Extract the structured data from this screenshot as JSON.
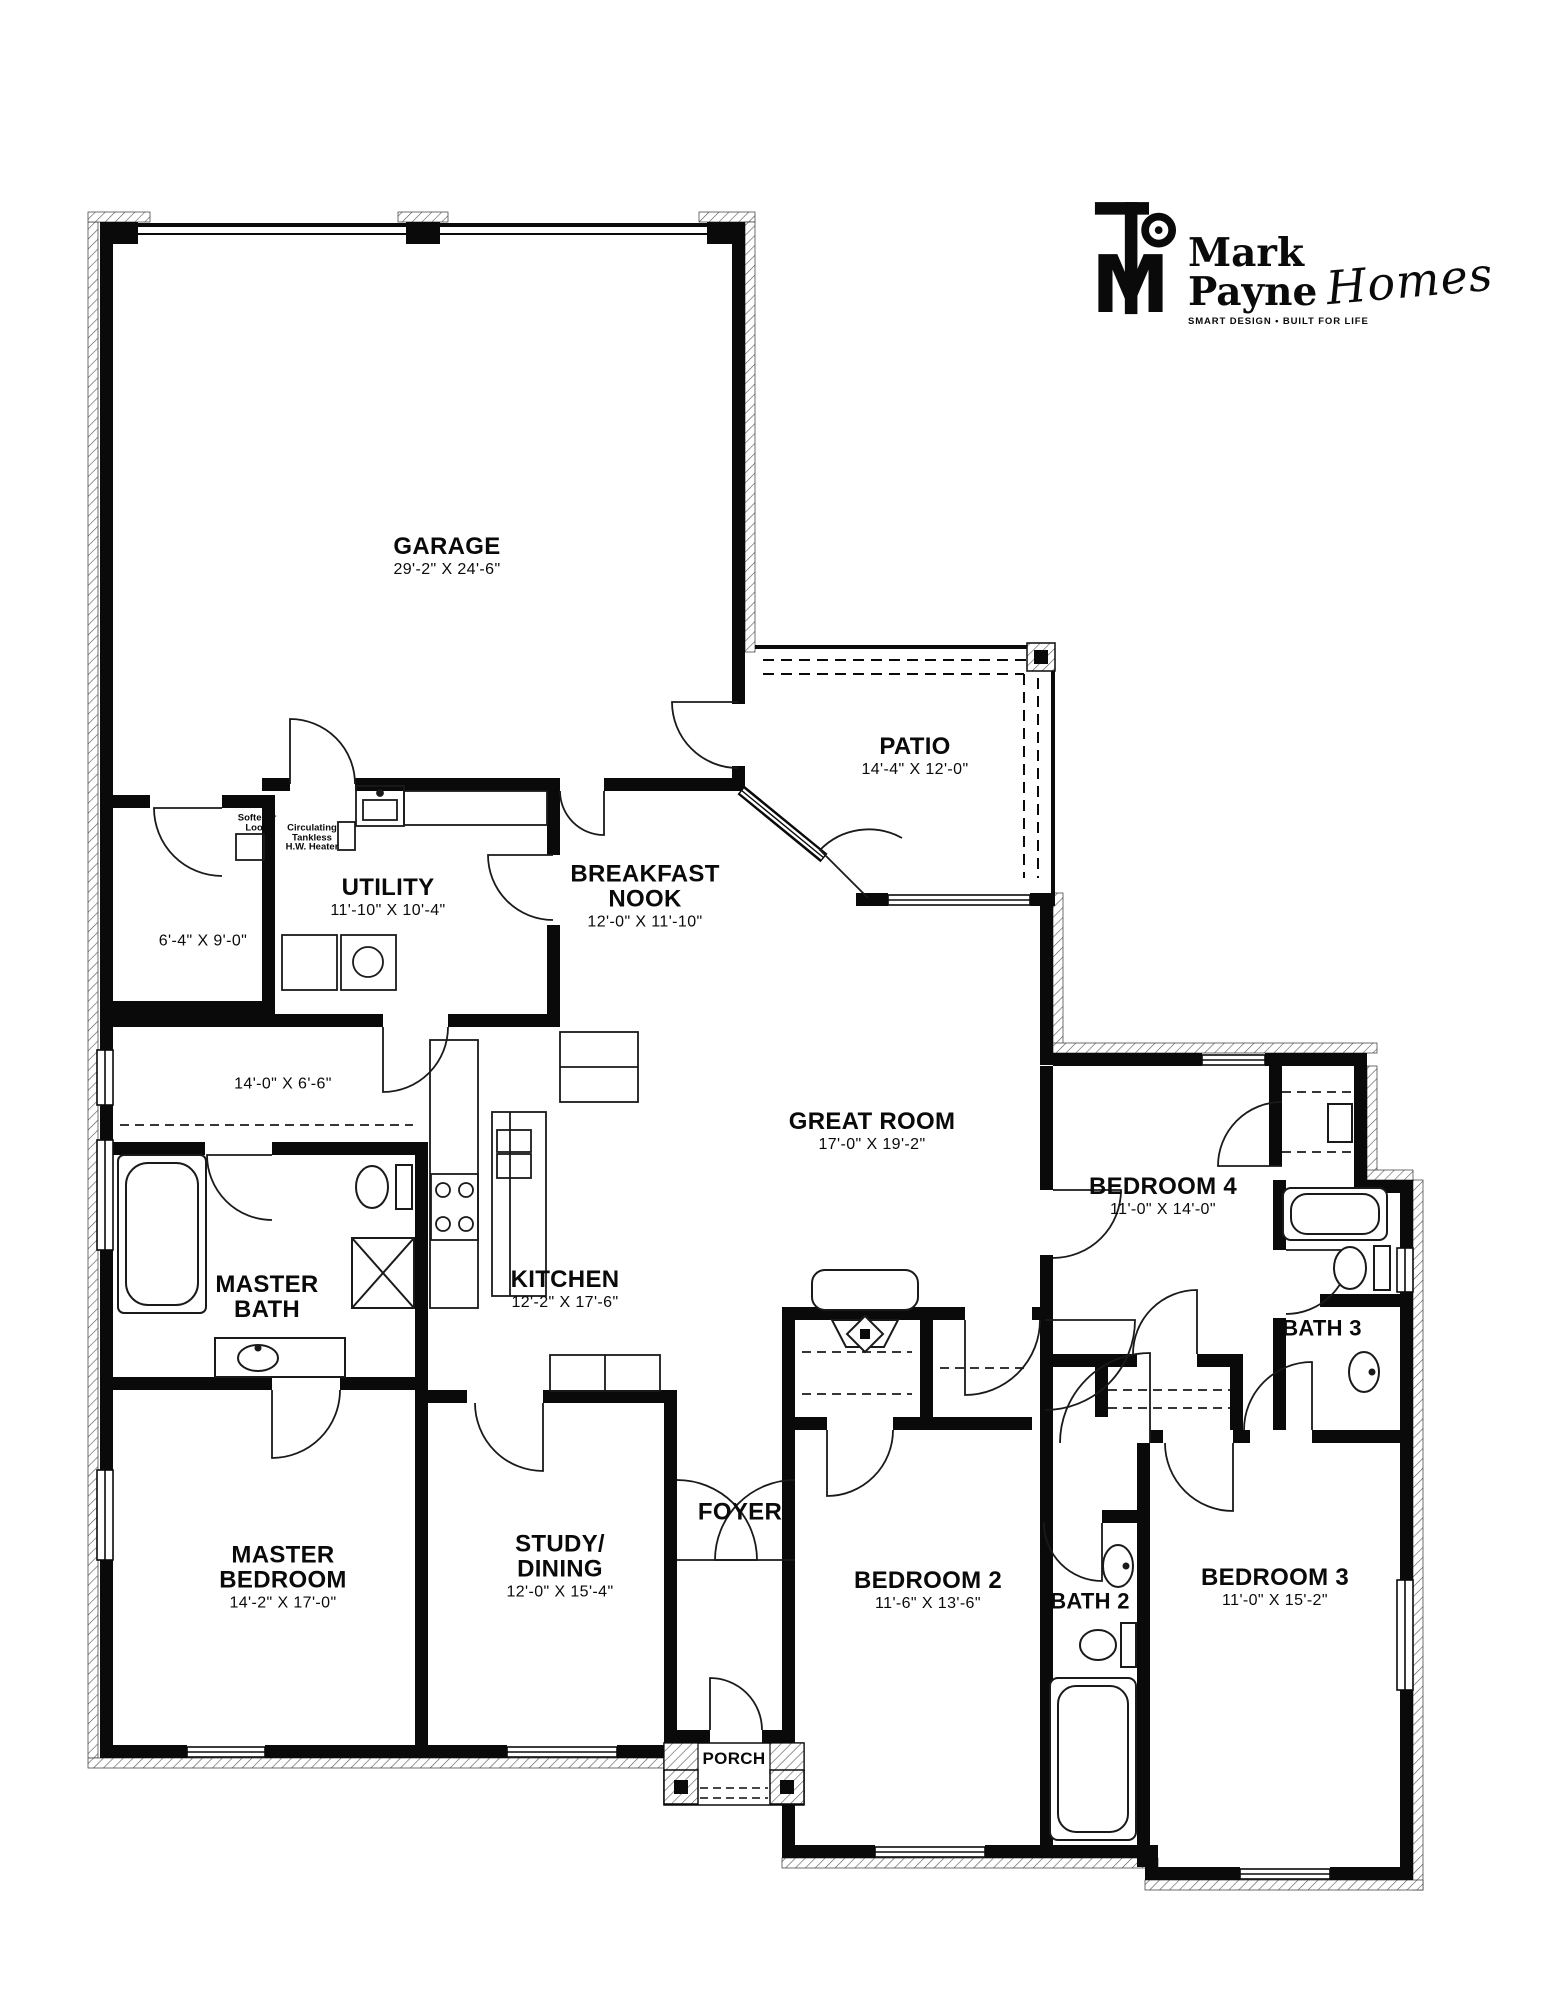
{
  "logo": {
    "company": "Mark Payne",
    "tagline": "SMART DESIGN • BUILT FOR LIFE",
    "script": "Homes",
    "monogram": "M"
  },
  "colors": {
    "ink": "#000000",
    "paper": "#ffffff"
  },
  "rooms": {
    "garage": {
      "line1": "GARAGE",
      "dims": "29'-2\" X 24'-6\""
    },
    "patio": {
      "line1": "PATIO",
      "dims": "14'-4\" X 12'-0\""
    },
    "utility": {
      "line1": "UTILITY",
      "dims": "11'-10\" X 10'-4\""
    },
    "breakfast": {
      "line1": "BREAKFAST",
      "line2": "NOOK",
      "dims": "12'-0\" X 11'-10\""
    },
    "storage": {
      "dims": "6'-4\" X 9'-0\""
    },
    "hallway": {
      "dims": "14'-0\" X 6'-6\""
    },
    "great_room": {
      "line1": "GREAT ROOM",
      "dims": "17'-0\" X 19'-2\""
    },
    "bedroom4": {
      "line1": "BEDROOM 4",
      "dims": "11'-0\" X 14'-0\""
    },
    "bath3": {
      "line1": "BATH 3"
    },
    "master_bath": {
      "line1": "MASTER",
      "line2": "BATH"
    },
    "kitchen": {
      "line1": "KITCHEN",
      "dims": "12'-2\" X 17'-6\""
    },
    "master_bedroom": {
      "line1": "MASTER",
      "line2": "BEDROOM",
      "dims": "14'-2\" X 17'-0\""
    },
    "study_dining": {
      "line1": "STUDY/",
      "line2": "DINING",
      "dims": "12'-0\" X 15'-4\""
    },
    "foyer": {
      "line1": "FOYER"
    },
    "bedroom2": {
      "line1": "BEDROOM 2",
      "dims": "11'-6\" X 13'-6\""
    },
    "bath2": {
      "line1": "BATH 2"
    },
    "bedroom3": {
      "line1": "BEDROOM 3",
      "dims": "11'-0\" X 15'-2\""
    },
    "porch": {
      "line1": "PORCH"
    }
  },
  "annotations": {
    "softener": {
      "line1": "Softener",
      "line2": "Loop"
    },
    "heater": {
      "line1": "Circulating",
      "line2": "Tankless",
      "line3": "H.W. Heater"
    }
  }
}
